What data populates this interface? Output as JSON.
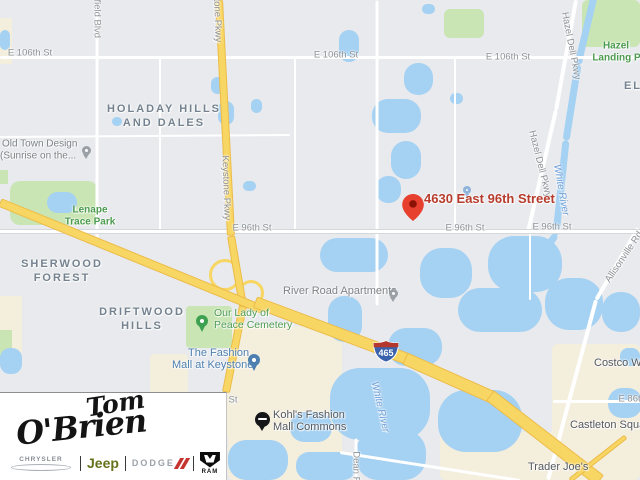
{
  "colors": {
    "map_bg": "#e8eaed",
    "water": "#a5d1f3",
    "park": "#c9e5b4",
    "commercial": "#f4eedd",
    "highway_fill": "#f8d663",
    "highway_edge": "#ecbc49",
    "marker_red": "#e8402f",
    "marker_label_red": "#b73c2d",
    "shield_blue": "#3a62ac",
    "shield_red": "#b5382f"
  },
  "map": {
    "marker": {
      "label": "4630 East 96th Street"
    },
    "shield": {
      "text": "465",
      "type": "interstate"
    },
    "zones": [
      {
        "x": 228,
        "y": 326,
        "w": 114,
        "h": 154,
        "r": 6,
        "k": "commercial"
      },
      {
        "x": 552,
        "y": 344,
        "w": 88,
        "h": 136,
        "r": 6,
        "k": "commercial"
      },
      {
        "x": 440,
        "y": 432,
        "w": 118,
        "h": 48,
        "r": 6,
        "k": "commercial"
      },
      {
        "x": 0,
        "y": 296,
        "w": 22,
        "h": 56,
        "r": 0,
        "k": "commercial"
      },
      {
        "x": 0,
        "y": 18,
        "w": 12,
        "h": 46,
        "r": 0,
        "k": "commercial"
      },
      {
        "x": 150,
        "y": 354,
        "w": 38,
        "h": 42,
        "r": 4,
        "k": "commercial"
      },
      {
        "x": 226,
        "y": 392,
        "w": 36,
        "h": 46,
        "r": 4,
        "k": "commercial"
      },
      {
        "x": 10,
        "y": 181,
        "w": 88,
        "h": 44,
        "r": 10,
        "k": "park"
      },
      {
        "x": 582,
        "y": 0,
        "w": 58,
        "h": 47,
        "r": 6,
        "k": "park"
      },
      {
        "x": 444,
        "y": 9,
        "w": 40,
        "h": 29,
        "r": 6,
        "k": "park"
      },
      {
        "x": 186,
        "y": 306,
        "w": 46,
        "h": 42,
        "r": 4,
        "k": "park"
      },
      {
        "x": 0,
        "y": 330,
        "w": 12,
        "h": 36,
        "r": 0,
        "k": "park"
      },
      {
        "x": 0,
        "y": 170,
        "w": 8,
        "h": 14,
        "r": 0,
        "k": "park"
      },
      {
        "x": 0,
        "y": 30,
        "w": 10,
        "h": 20,
        "r": 8,
        "k": "water"
      },
      {
        "x": 211,
        "y": 77,
        "w": 13,
        "h": 17,
        "r": 8,
        "k": "water"
      },
      {
        "x": 218,
        "y": 101,
        "w": 16,
        "h": 24,
        "r": 10,
        "k": "water"
      },
      {
        "x": 251,
        "y": 99,
        "w": 11,
        "h": 14,
        "r": 7,
        "k": "water"
      },
      {
        "x": 112,
        "y": 117,
        "w": 10,
        "h": 9,
        "r": 5,
        "k": "water"
      },
      {
        "x": 243,
        "y": 181,
        "w": 13,
        "h": 10,
        "r": 6,
        "k": "water"
      },
      {
        "x": 47,
        "y": 192,
        "w": 30,
        "h": 21,
        "r": 12,
        "k": "water"
      },
      {
        "x": 339,
        "y": 30,
        "w": 20,
        "h": 32,
        "r": 12,
        "k": "water"
      },
      {
        "x": 404,
        "y": 63,
        "w": 29,
        "h": 32,
        "r": 14,
        "k": "water"
      },
      {
        "x": 372,
        "y": 99,
        "w": 49,
        "h": 34,
        "r": 16,
        "k": "water"
      },
      {
        "x": 391,
        "y": 141,
        "w": 30,
        "h": 38,
        "r": 15,
        "k": "water"
      },
      {
        "x": 376,
        "y": 176,
        "w": 25,
        "h": 27,
        "r": 12,
        "k": "water"
      },
      {
        "x": 450,
        "y": 93,
        "w": 13,
        "h": 11,
        "r": 6,
        "k": "water"
      },
      {
        "x": 422,
        "y": 4,
        "w": 13,
        "h": 10,
        "r": 6,
        "k": "water"
      },
      {
        "x": 320,
        "y": 238,
        "w": 68,
        "h": 34,
        "r": 17,
        "k": "water"
      },
      {
        "x": 420,
        "y": 248,
        "w": 52,
        "h": 50,
        "r": 22,
        "k": "water"
      },
      {
        "x": 488,
        "y": 236,
        "w": 74,
        "h": 56,
        "r": 26,
        "k": "water"
      },
      {
        "x": 458,
        "y": 288,
        "w": 84,
        "h": 44,
        "r": 22,
        "k": "water"
      },
      {
        "x": 328,
        "y": 296,
        "w": 34,
        "h": 46,
        "r": 16,
        "k": "water"
      },
      {
        "x": 388,
        "y": 328,
        "w": 54,
        "h": 38,
        "r": 18,
        "k": "water"
      },
      {
        "x": 330,
        "y": 368,
        "w": 100,
        "h": 72,
        "r": 30,
        "k": "water"
      },
      {
        "x": 356,
        "y": 430,
        "w": 70,
        "h": 50,
        "r": 22,
        "k": "water"
      },
      {
        "x": 438,
        "y": 390,
        "w": 84,
        "h": 62,
        "r": 28,
        "k": "water"
      },
      {
        "x": 545,
        "y": 278,
        "w": 58,
        "h": 52,
        "r": 24,
        "k": "water"
      },
      {
        "x": 602,
        "y": 292,
        "w": 38,
        "h": 40,
        "r": 18,
        "k": "water"
      },
      {
        "x": 608,
        "y": 388,
        "w": 34,
        "h": 30,
        "r": 14,
        "k": "water"
      },
      {
        "x": 228,
        "y": 440,
        "w": 60,
        "h": 40,
        "r": 18,
        "k": "water"
      },
      {
        "x": 290,
        "y": 412,
        "w": 42,
        "h": 30,
        "r": 14,
        "k": "water"
      },
      {
        "x": 296,
        "y": 452,
        "w": 60,
        "h": 28,
        "r": 13,
        "k": "water"
      },
      {
        "x": 0,
        "y": 348,
        "w": 22,
        "h": 26,
        "r": 10,
        "k": "water"
      },
      {
        "x": 620,
        "y": 348,
        "w": 20,
        "h": 18,
        "r": 8,
        "k": "water"
      }
    ],
    "roads": [
      {
        "x1": 0,
        "y1": 57,
        "x2": 640,
        "y2": 57,
        "w": 3,
        "k": "minor"
      },
      {
        "x1": 97,
        "y1": 0,
        "x2": 97,
        "y2": 238,
        "w": 3,
        "k": "minor"
      },
      {
        "x1": 295,
        "y1": 57,
        "x2": 295,
        "y2": 231,
        "w": 2,
        "k": "minor"
      },
      {
        "x1": 377,
        "y1": 0,
        "x2": 377,
        "y2": 305,
        "w": 3,
        "k": "minor"
      },
      {
        "x1": 160,
        "y1": 57,
        "x2": 160,
        "y2": 231,
        "w": 2,
        "k": "minor"
      },
      {
        "x1": 455,
        "y1": 57,
        "x2": 455,
        "y2": 231,
        "w": 2,
        "k": "minor"
      },
      {
        "x1": 0,
        "y1": 137,
        "x2": 290,
        "y2": 135,
        "w": 2,
        "k": "minor"
      },
      {
        "x1": 576,
        "y1": 0,
        "x2": 556,
        "y2": 110,
        "w": 4,
        "k": "minor"
      },
      {
        "x1": 556,
        "y1": 110,
        "x2": 528,
        "y2": 232,
        "w": 4,
        "k": "minor"
      },
      {
        "x1": 638,
        "y1": 228,
        "x2": 596,
        "y2": 300,
        "w": 4,
        "k": "minor"
      },
      {
        "x1": 596,
        "y1": 300,
        "x2": 548,
        "y2": 480,
        "w": 4,
        "k": "minor"
      },
      {
        "x1": 553,
        "y1": 401,
        "x2": 640,
        "y2": 401,
        "w": 3,
        "k": "minor"
      },
      {
        "x1": 356,
        "y1": 438,
        "x2": 356,
        "y2": 480,
        "w": 3,
        "k": "minor"
      },
      {
        "x1": 340,
        "y1": 452,
        "x2": 520,
        "y2": 480,
        "w": 3,
        "k": "minor"
      },
      {
        "x1": 530,
        "y1": 232,
        "x2": 530,
        "y2": 300,
        "w": 2,
        "k": "minor"
      },
      {
        "x1": 0,
        "y1": 231,
        "x2": 640,
        "y2": 231,
        "w": 5,
        "k": "major"
      },
      {
        "x1": 594,
        "y1": -4,
        "x2": 578,
        "y2": 64,
        "w": 7,
        "k": "river"
      },
      {
        "x1": 578,
        "y1": 64,
        "x2": 566,
        "y2": 140,
        "w": 7,
        "k": "river"
      },
      {
        "x1": 566,
        "y1": 140,
        "x2": 556,
        "y2": 234,
        "w": 7,
        "k": "river"
      },
      {
        "x1": 556,
        "y1": 234,
        "x2": 536,
        "y2": 262,
        "w": 7,
        "k": "river"
      },
      {
        "x1": 219,
        "y1": 0,
        "x2": 231,
        "y2": 236,
        "w": 8,
        "k": "highway"
      },
      {
        "x1": 231,
        "y1": 236,
        "x2": 243,
        "y2": 306,
        "w": 8,
        "k": "highway"
      },
      {
        "x1": 243,
        "y1": 306,
        "x2": 226,
        "y2": 392,
        "w": 8,
        "k": "highway"
      },
      {
        "x1": 0,
        "y1": 202,
        "x2": 262,
        "y2": 309,
        "w": 9,
        "k": "highway"
      },
      {
        "x1": 255,
        "y1": 302,
        "x2": 410,
        "y2": 360,
        "w": 12,
        "k": "highway"
      },
      {
        "x1": 405,
        "y1": 358,
        "x2": 495,
        "y2": 398,
        "w": 13,
        "k": "highway"
      },
      {
        "x1": 490,
        "y1": 395,
        "x2": 600,
        "y2": 480,
        "w": 13,
        "k": "highway"
      },
      {
        "x1": 570,
        "y1": 480,
        "x2": 626,
        "y2": 436,
        "w": 5,
        "k": "highway"
      }
    ],
    "rings": [
      {
        "x": 222,
        "y": 272,
        "d": 26
      },
      {
        "x": 248,
        "y": 290,
        "d": 20
      }
    ],
    "labels": [
      {
        "t": "E 106th St",
        "x": 30,
        "y": 53,
        "k": "st"
      },
      {
        "t": "E 106th St",
        "x": 336,
        "y": 55,
        "k": "st"
      },
      {
        "t": "E 106th St",
        "x": 508,
        "y": 57,
        "k": "st"
      },
      {
        "t": "E 96th St",
        "x": 252,
        "y": 228,
        "k": "st"
      },
      {
        "t": "E 96th St",
        "x": 465,
        "y": 228,
        "k": "st"
      },
      {
        "t": "E 96th St",
        "x": 552,
        "y": 227,
        "k": "st"
      },
      {
        "t": "E 86th St",
        "x": 218,
        "y": 400,
        "k": "st"
      },
      {
        "t": "E 86th St",
        "x": 638,
        "y": 399,
        "k": "st"
      },
      {
        "t": "Keystone Pkwy",
        "x": 217,
        "y": 10,
        "r": 88,
        "k": "rd"
      },
      {
        "t": "Keystone Pkwy",
        "x": 226,
        "y": 188,
        "r": 88,
        "k": "rd"
      },
      {
        "t": "Westfield Blvd",
        "x": 97,
        "y": 8,
        "r": 90,
        "k": "rd"
      },
      {
        "t": "Hazel Dell Pkwy",
        "x": 571,
        "y": 46,
        "r": 79,
        "k": "rd"
      },
      {
        "t": "Hazel Dell Pkwy",
        "x": 540,
        "y": 164,
        "r": 76,
        "k": "rd"
      },
      {
        "t": "Allisonville Rd",
        "x": 624,
        "y": 257,
        "r": -56,
        "k": "rd"
      },
      {
        "t": "Dean Rd",
        "x": 356,
        "y": 470,
        "r": 90,
        "k": "rd"
      },
      {
        "t": "HOLADAY HILLS",
        "x": 164,
        "y": 109,
        "k": "ar"
      },
      {
        "t": "AND DALES",
        "x": 164,
        "y": 123,
        "k": "ar"
      },
      {
        "t": "SHERWOOD",
        "x": 62,
        "y": 264,
        "k": "ar"
      },
      {
        "t": "FOREST",
        "x": 62,
        "y": 278,
        "k": "ar"
      },
      {
        "t": "DRIFTWOOD",
        "x": 142,
        "y": 312,
        "k": "ar"
      },
      {
        "t": "HILLS",
        "x": 142,
        "y": 326,
        "k": "ar"
      },
      {
        "t": "EL",
        "x": 633,
        "y": 86,
        "k": "ar"
      },
      {
        "t": "Lenape",
        "x": 90,
        "y": 210,
        "k": "pk"
      },
      {
        "t": "Trace Park",
        "x": 90,
        "y": 222,
        "k": "pk"
      },
      {
        "t": "Hazel",
        "x": 616,
        "y": 46,
        "k": "pk"
      },
      {
        "t": "Landing Park",
        "x": 624,
        "y": 58,
        "k": "pk"
      },
      {
        "t": "Our Lady of",
        "x": 214,
        "y": 313,
        "k": "pgr",
        "a": "l"
      },
      {
        "t": "Peace Cemetery",
        "x": 214,
        "y": 325,
        "k": "pgr",
        "a": "l"
      },
      {
        "t": "Old Town Design",
        "x": 2,
        "y": 144,
        "k": "pg",
        "a": "l"
      },
      {
        "t": "(Sunrise on the...",
        "x": 0,
        "y": 156,
        "k": "pg",
        "a": "l"
      },
      {
        "t": "River Road Apartments",
        "x": 283,
        "y": 291,
        "k": "pg2",
        "a": "l"
      },
      {
        "t": "Kohl's Fashion",
        "x": 273,
        "y": 415,
        "k": "pd",
        "a": "l"
      },
      {
        "t": "Mall Commons",
        "x": 273,
        "y": 427,
        "k": "pd",
        "a": "l"
      },
      {
        "t": "Castleton Square",
        "x": 570,
        "y": 425,
        "k": "pd",
        "a": "l"
      },
      {
        "t": "Trader Joe's",
        "x": 528,
        "y": 467,
        "k": "pd",
        "a": "l"
      },
      {
        "t": "Costco Wholesale",
        "x": 594,
        "y": 363,
        "k": "pd",
        "a": "l"
      },
      {
        "t": "The Fashion",
        "x": 188,
        "y": 353,
        "k": "pb",
        "a": "l"
      },
      {
        "t": "Mall at Keystone",
        "x": 172,
        "y": 365,
        "k": "pb",
        "a": "l"
      },
      {
        "t": "White River",
        "x": 561,
        "y": 190,
        "r": 80,
        "k": "wt"
      },
      {
        "t": "White River",
        "x": 380,
        "y": 407,
        "r": 77,
        "k": "wt"
      }
    ],
    "pins": [
      {
        "k": "gray",
        "x": 86,
        "y": 150,
        "name": "old-town-design-pin-icon"
      },
      {
        "k": "gray",
        "x": 393,
        "y": 293,
        "name": "river-road-apartments-pin-icon"
      },
      {
        "k": "green",
        "x": 202,
        "y": 321,
        "name": "cemetery-pin-icon"
      },
      {
        "k": "shop",
        "x": 254,
        "y": 360,
        "name": "fashion-mall-shopping-pin-icon"
      },
      {
        "k": "shopsm",
        "x": 467,
        "y": 190,
        "name": "small-shopping-pin-icon"
      },
      {
        "k": "kohls",
        "x": 262,
        "y": 419,
        "name": "kohls-logo-pin-icon"
      }
    ]
  },
  "logo": {
    "script": {
      "line1": "Tom",
      "line2": "O'Brien"
    },
    "brands": {
      "chrysler": "CHRYSLER",
      "jeep": "Jeep",
      "dodge": "DODGE",
      "ram": "RAM"
    }
  }
}
